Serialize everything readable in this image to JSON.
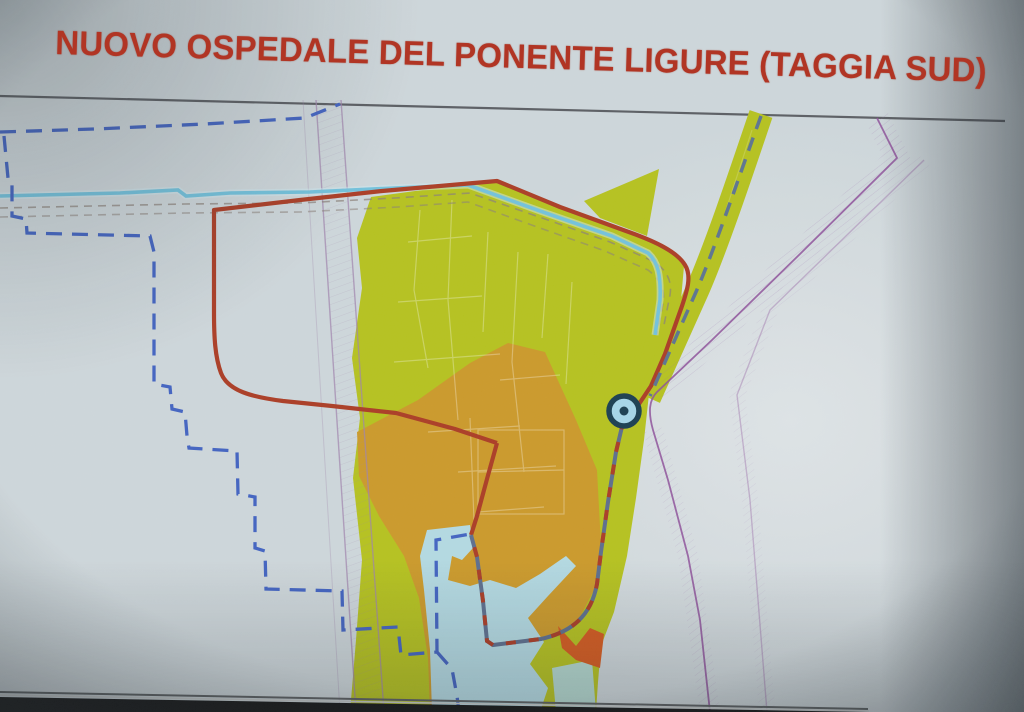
{
  "title": {
    "text": "NUOVO OSPEDALE DEL PONENTE LIGURE (TAGGIA SUD)"
  },
  "colors": {
    "title_red": "#b13524",
    "paper": "#cfd8dc",
    "glare": "#e6eaec",
    "rule_gray": "#4c5054",
    "site_green": "#b6c31c",
    "site_orange": "#cd9a28",
    "water_blue": "#b4dbe4",
    "alert_orange": "#d6591c",
    "stream_cyan": "#72c3de",
    "boundary_blue": "#4062c2",
    "perimeter_red": "#ab3a22",
    "merged_slate": "#5b6d8d",
    "road_dash_slate": "#5b7390",
    "road_purple": "#8d4f9a",
    "corridor_purple": "#a083ad",
    "cadastral_white": "#ffffff",
    "gray_dash": "#8a8078",
    "marker_ring": "#173d4f",
    "marker_fill": "#a6d8ea",
    "screen_black": "#101010",
    "bezel_light": "#c8cccc",
    "bezel_dark": "#5a5e60"
  },
  "marker": {
    "name": "site-location-marker"
  }
}
